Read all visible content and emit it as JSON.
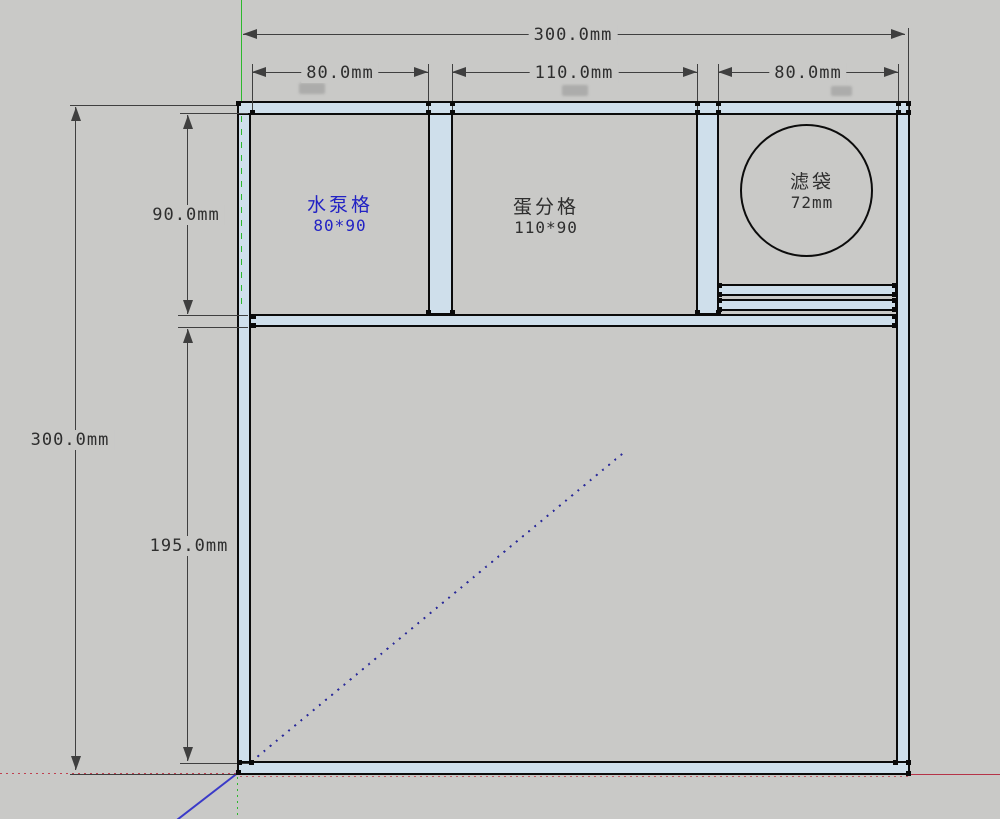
{
  "dims": {
    "width_total": "300.0mm",
    "seg1": "80.0mm",
    "seg2": "110.0mm",
    "seg3": "80.0mm",
    "height_total": "300.0mm",
    "upper": "90.0mm",
    "lower": "195.0mm"
  },
  "compartments": {
    "pump": {
      "label": "水泵格",
      "size": "80*90"
    },
    "skimmer": {
      "label": "蛋分格",
      "size": "110*90"
    },
    "filter_bag": {
      "label": "滤袋",
      "size": "72mm"
    }
  },
  "colors": {
    "background": "#c9c9c7",
    "panel_fill": "#cfdfeb",
    "edge": "#0b0b0b",
    "dimension": "#3f3f3f",
    "pump_text": "#2222c4",
    "axis_green": "#2db82d",
    "axis_red": "#c04050",
    "axis_blue": "#3a3ac8"
  }
}
